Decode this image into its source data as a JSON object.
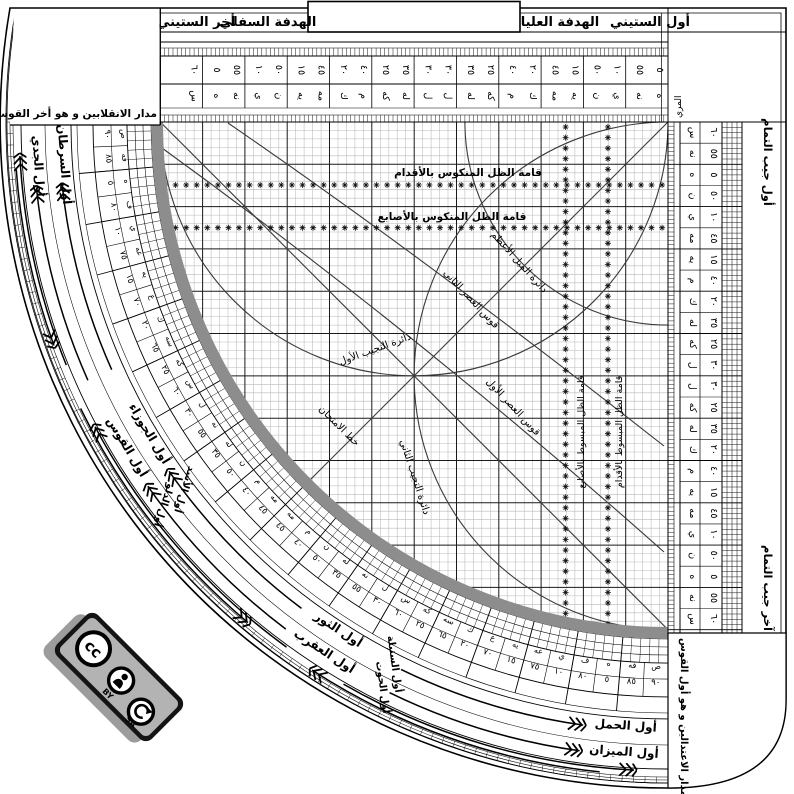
{
  "title": "Sine quadrant (al-rubʿ al-mujayyab) diagram",
  "colors": {
    "line": "#000000",
    "grid_thin": "#b9b9b9",
    "grid_major": "#1a1a1a",
    "curve": "#3a3a3a",
    "limb": "#8d8d8d",
    "badge_bg": "#141414",
    "badge_panel": "#b3b3b3",
    "badge_shadow": "#9c9c9c"
  },
  "top_bar": {
    "first": "أول الستيني",
    "upper_sight": "الهدفة العليا",
    "lower_sight": "الهدفة السفلي",
    "last": "أخر الستيني"
  },
  "cosine": {
    "first": "أول جيب التمام",
    "last": "آخر جيب التمام"
  },
  "boxes": {
    "solstices": "مدار الانقلابين و هو أخر القوس",
    "equinoxes": "مدار الاعتدالين و هو أول القوس"
  },
  "muri": "المري",
  "grid_labels": {
    "reversed_feet": "قامة الظل المنكوس بالأقدام",
    "reversed_digits": "قامة الظل المنكوس بالأصابع",
    "max_declination": "دائرة الميل الأعظم",
    "asr_second": "قوس العصر الثاني",
    "asr_first": "قوس العصر الأول",
    "tajyib_first": "دائرة التجيب الأول",
    "tajyib_second": "دائرة التجيب الثاني",
    "test_line": "خط الامتحان",
    "extended_digits": "قامة الظل المبسوط بالأصابع",
    "extended_feet": "قامة الظل المبسوط بالأقدام"
  },
  "top_scale": {
    "cells": [
      {
        "asc": "٥",
        "desc": "٥٥",
        "a1": "ه",
        "a2": "نه"
      },
      {
        "asc": "١٠",
        "desc": "٥٠",
        "a1": "ي",
        "a2": "ن"
      },
      {
        "asc": "١٥",
        "desc": "٤٥",
        "a1": "يه",
        "a2": "مه"
      },
      {
        "asc": "٢٠",
        "desc": "٤٠",
        "a1": "ك",
        "a2": "م"
      },
      {
        "asc": "٢٥",
        "desc": "٣٥",
        "a1": "كه",
        "a2": "له"
      },
      {
        "asc": "٣٠",
        "desc": "٣٠",
        "a1": "ل",
        "a2": "ل"
      },
      {
        "asc": "٣٥",
        "desc": "٢٥",
        "a1": "له",
        "a2": "كه"
      },
      {
        "asc": "٤٠",
        "desc": "٢٠",
        "a1": "م",
        "a2": "ك"
      },
      {
        "asc": "٤٥",
        "desc": "١٥",
        "a1": "مه",
        "a2": "يه"
      },
      {
        "asc": "٥٠",
        "desc": "١٠",
        "a1": "ن",
        "a2": "ي"
      },
      {
        "asc": "٥٥",
        "desc": "٥",
        "a1": "نه",
        "a2": "ه"
      },
      {
        "asc": "٦٠",
        "desc": "",
        "a1": "س",
        "a2": ""
      }
    ]
  },
  "right_scale": {
    "rows": [
      {
        "num": "٦٠",
        "abjad": "س"
      },
      {
        "num": "٥٥",
        "abjad": "نه"
      },
      {
        "num": "٥",
        "abjad": "ه"
      },
      {
        "num": "٥٠",
        "abjad": "ن"
      },
      {
        "num": "١٠",
        "abjad": "ي"
      },
      {
        "num": "٤٥",
        "abjad": "مه"
      },
      {
        "num": "١٥",
        "abjad": "يه"
      },
      {
        "num": "٤٠",
        "abjad": "م"
      },
      {
        "num": "٢٠",
        "abjad": "ك"
      },
      {
        "num": "٣٥",
        "abjad": "له"
      },
      {
        "num": "٢٥",
        "abjad": "كه"
      },
      {
        "num": "٣٠",
        "abjad": "ل"
      },
      {
        "num": "٣٠",
        "abjad": "ل"
      },
      {
        "num": "٢٥",
        "abjad": "كه"
      },
      {
        "num": "٣٥",
        "abjad": "له"
      },
      {
        "num": "٢٠",
        "abjad": "ك"
      },
      {
        "num": "٤٠",
        "abjad": "م"
      },
      {
        "num": "١٥",
        "abjad": "يه"
      },
      {
        "num": "٤٥",
        "abjad": "مه"
      },
      {
        "num": "١٠",
        "abjad": "ي"
      },
      {
        "num": "٥٠",
        "abjad": "ن"
      },
      {
        "num": "٥",
        "abjad": "ه"
      },
      {
        "num": "٥٥",
        "abjad": "نه"
      },
      {
        "num": "٦٠",
        "abjad": "س"
      }
    ]
  },
  "rim": {
    "cells": [
      {
        "num": "٩٠",
        "abjad": "ص"
      },
      {
        "num": "٨٥",
        "abjad": "فه"
      },
      {
        "num": "٥",
        "abjad": "ه"
      },
      {
        "num": "٨٠",
        "abjad": "ف"
      },
      {
        "num": "١٠",
        "abjad": "ي"
      },
      {
        "num": "٧٥",
        "abjad": "عه"
      },
      {
        "num": "١٥",
        "abjad": "يه"
      },
      {
        "num": "٧٠",
        "abjad": "ع"
      },
      {
        "num": "٢٠",
        "abjad": "ك"
      },
      {
        "num": "٦٥",
        "abjad": "سه"
      },
      {
        "num": "٢٥",
        "abjad": "كه"
      },
      {
        "num": "٦٠",
        "abjad": "س"
      },
      {
        "num": "٣٠",
        "abjad": "ل"
      },
      {
        "num": "٥٥",
        "abjad": "نه"
      },
      {
        "num": "٣٥",
        "abjad": "له"
      },
      {
        "num": "٥٠",
        "abjad": "ن"
      },
      {
        "num": "٤٠",
        "abjad": "م"
      },
      {
        "num": "٤٥",
        "abjad": "مه"
      },
      {
        "num": "٤٥",
        "abjad": "مه"
      },
      {
        "num": "٤٠",
        "abjad": "م"
      },
      {
        "num": "٥٠",
        "abjad": "ن"
      },
      {
        "num": "٣٥",
        "abjad": "له"
      },
      {
        "num": "٥٥",
        "abjad": "نه"
      },
      {
        "num": "٣٠",
        "abjad": "ل"
      },
      {
        "num": "٦٠",
        "abjad": "س"
      },
      {
        "num": "٢٥",
        "abjad": "كه"
      },
      {
        "num": "٦٥",
        "abjad": "سه"
      },
      {
        "num": "٢٠",
        "abjad": "ك"
      },
      {
        "num": "٧٠",
        "abjad": "ع"
      },
      {
        "num": "١٥",
        "abjad": "يه"
      },
      {
        "num": "٧٥",
        "abjad": "عه"
      },
      {
        "num": "١٠",
        "abjad": "ي"
      },
      {
        "num": "٨٠",
        "abjad": "ف"
      },
      {
        "num": "٥",
        "abjad": "ه"
      },
      {
        "num": "٨٥",
        "abjad": "فه"
      },
      {
        "num": "٩٠",
        "abjad": "ص"
      }
    ],
    "zodiac_inner": [
      {
        "text": "أول السرطان",
        "t": 86
      },
      {
        "text": "أول الجوزاء",
        "t": 59
      },
      {
        "text": "أول الثور",
        "t": 33
      },
      {
        "text": "أول الحمل",
        "t": 4
      }
    ],
    "zodiac_inner_secondary": [
      {
        "text": "أول الأسد",
        "t": 53
      },
      {
        "text": "أول السنبلة",
        "t": 27
      }
    ],
    "zodiac_outer": [
      {
        "text": "أول الجدي",
        "t": 86
      },
      {
        "text": "أول القوس",
        "t": 59
      },
      {
        "text": "أول العقرب",
        "t": 33
      },
      {
        "text": "أول الميزان",
        "t": 4
      }
    ],
    "zodiac_outer_secondary": [
      {
        "text": "أول الدلو",
        "t": 53
      },
      {
        "text": "أول الحوت",
        "t": 27
      }
    ],
    "arrows": [
      {
        "r": 609,
        "t1": 66,
        "t2": 84,
        "dir": "up"
      },
      {
        "r": 635,
        "t1": 66,
        "t2": 84,
        "dir": "up"
      },
      {
        "r": 609,
        "t1": 37,
        "t2": 55,
        "dir": "up"
      },
      {
        "r": 635,
        "t1": 37,
        "t2": 55,
        "dir": "up"
      },
      {
        "r": 609,
        "t1": 8,
        "t2": 26,
        "dir": "down"
      },
      {
        "r": 635,
        "t1": 8,
        "t2": 26,
        "dir": "down"
      },
      {
        "r": 649,
        "t1": 3,
        "t2": 30,
        "dir": "down"
      },
      {
        "r": 653.5,
        "t1": 6,
        "t2": 33,
        "dir": "up"
      },
      {
        "r": 649,
        "t1": 36,
        "t2": 62,
        "dir": "up"
      },
      {
        "r": 653.5,
        "t1": 40,
        "t2": 64,
        "dir": "down"
      },
      {
        "r": 649,
        "t1": 68,
        "t2": 87,
        "dir": "up"
      },
      {
        "r": 653.5,
        "t1": 70,
        "t2": 86,
        "dir": "down"
      }
    ]
  },
  "license": {
    "cc": "cc",
    "by": "BY",
    "sa": "SA"
  }
}
